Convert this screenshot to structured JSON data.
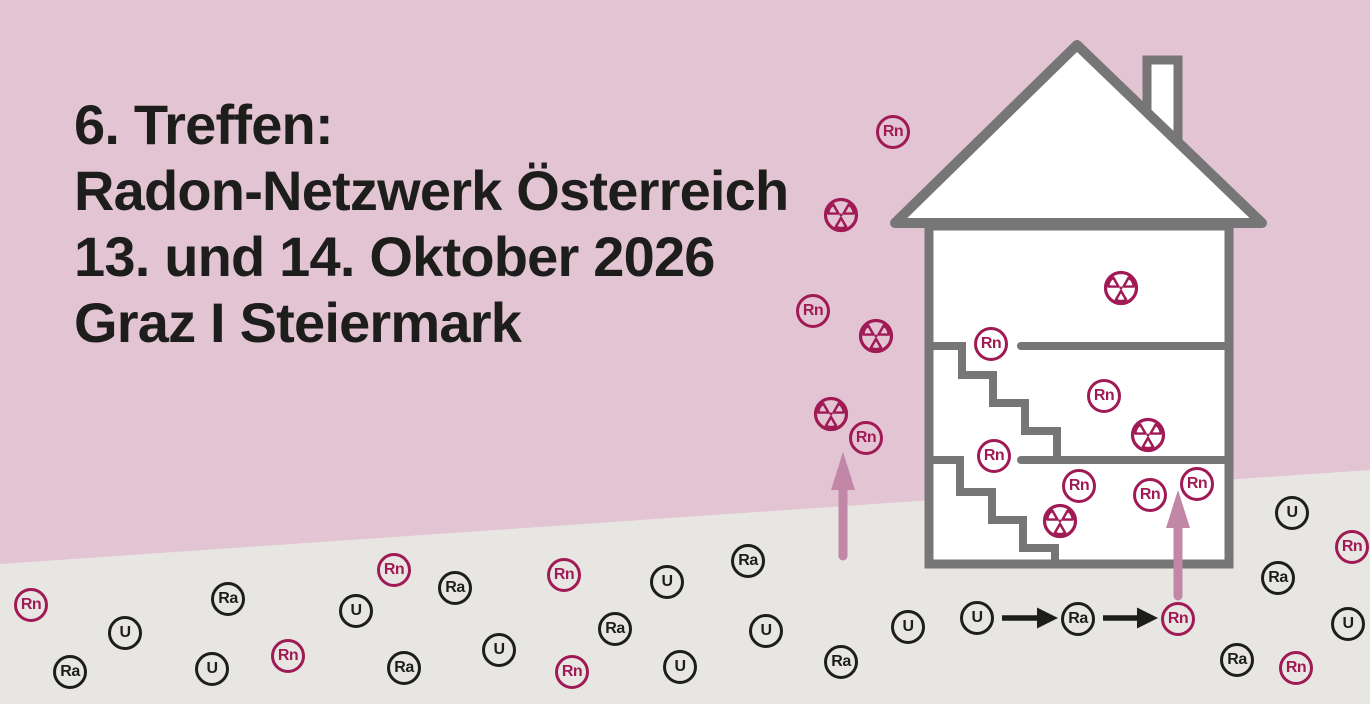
{
  "title": {
    "lines": [
      "6. Treffen:",
      "Radon-Netzwerk Österreich",
      "13. und 14. Oktober 2026",
      "Graz I Steiermark"
    ]
  },
  "colors": {
    "sky_pink": "#e2c4d2",
    "ground_gray": "#e8e6e3",
    "house_gray": "#767676",
    "house_fill": "#ffffff",
    "magenta": "#a01a55",
    "ink": "#1d1d1b",
    "arrow_pink": "#c286a7"
  },
  "symbols": [
    {
      "type": "element",
      "label": "Rn",
      "x": 893,
      "y": 132,
      "color": "magenta"
    },
    {
      "type": "trefoil",
      "x": 841,
      "y": 215,
      "color": "magenta"
    },
    {
      "type": "element",
      "label": "Rn",
      "x": 813,
      "y": 311,
      "color": "magenta"
    },
    {
      "type": "trefoil",
      "x": 876,
      "y": 336,
      "color": "magenta"
    },
    {
      "type": "trefoil",
      "x": 831,
      "y": 414,
      "color": "magenta"
    },
    {
      "type": "element",
      "label": "Rn",
      "x": 866,
      "y": 438,
      "color": "magenta"
    },
    {
      "type": "trefoil",
      "x": 1121,
      "y": 288,
      "color": "magenta"
    },
    {
      "type": "element",
      "label": "Rn",
      "x": 991,
      "y": 344,
      "color": "magenta"
    },
    {
      "type": "element",
      "label": "Rn",
      "x": 1104,
      "y": 396,
      "color": "magenta"
    },
    {
      "type": "trefoil",
      "x": 1148,
      "y": 435,
      "color": "magenta"
    },
    {
      "type": "element",
      "label": "Rn",
      "x": 994,
      "y": 456,
      "color": "magenta"
    },
    {
      "type": "element",
      "label": "Rn",
      "x": 1079,
      "y": 486,
      "color": "magenta"
    },
    {
      "type": "element",
      "label": "Rn",
      "x": 1150,
      "y": 495,
      "color": "magenta"
    },
    {
      "type": "element",
      "label": "Rn",
      "x": 1197,
      "y": 484,
      "color": "magenta"
    },
    {
      "type": "trefoil",
      "x": 1060,
      "y": 521,
      "color": "magenta"
    },
    {
      "type": "element",
      "label": "U",
      "x": 1292,
      "y": 513,
      "color": "black"
    },
    {
      "type": "element",
      "label": "Rn",
      "x": 1352,
      "y": 547,
      "color": "magenta"
    },
    {
      "type": "element",
      "label": "Ra",
      "x": 1278,
      "y": 578,
      "color": "black"
    },
    {
      "type": "element",
      "label": "U",
      "x": 1348,
      "y": 624,
      "color": "black"
    },
    {
      "type": "element",
      "label": "Ra",
      "x": 1237,
      "y": 660,
      "color": "black"
    },
    {
      "type": "element",
      "label": "Rn",
      "x": 1296,
      "y": 668,
      "color": "magenta"
    },
    {
      "type": "element",
      "label": "Rn",
      "x": 31,
      "y": 605,
      "color": "magenta"
    },
    {
      "type": "element",
      "label": "U",
      "x": 125,
      "y": 633,
      "color": "black"
    },
    {
      "type": "element",
      "label": "Ra",
      "x": 70,
      "y": 672,
      "color": "black"
    },
    {
      "type": "element",
      "label": "Ra",
      "x": 228,
      "y": 599,
      "color": "black"
    },
    {
      "type": "element",
      "label": "U",
      "x": 212,
      "y": 669,
      "color": "black"
    },
    {
      "type": "element",
      "label": "Rn",
      "x": 288,
      "y": 656,
      "color": "magenta"
    },
    {
      "type": "element",
      "label": "U",
      "x": 356,
      "y": 611,
      "color": "black"
    },
    {
      "type": "element",
      "label": "Rn",
      "x": 394,
      "y": 570,
      "color": "magenta"
    },
    {
      "type": "element",
      "label": "Ra",
      "x": 455,
      "y": 588,
      "color": "black"
    },
    {
      "type": "element",
      "label": "Ra",
      "x": 404,
      "y": 668,
      "color": "black"
    },
    {
      "type": "element",
      "label": "U",
      "x": 499,
      "y": 650,
      "color": "black"
    },
    {
      "type": "element",
      "label": "Rn",
      "x": 564,
      "y": 575,
      "color": "magenta"
    },
    {
      "type": "element",
      "label": "Ra",
      "x": 615,
      "y": 629,
      "color": "black"
    },
    {
      "type": "element",
      "label": "Rn",
      "x": 572,
      "y": 672,
      "color": "magenta"
    },
    {
      "type": "element",
      "label": "U",
      "x": 667,
      "y": 582,
      "color": "black"
    },
    {
      "type": "element",
      "label": "U",
      "x": 680,
      "y": 667,
      "color": "black"
    },
    {
      "type": "element",
      "label": "Ra",
      "x": 748,
      "y": 561,
      "color": "black"
    },
    {
      "type": "element",
      "label": "U",
      "x": 766,
      "y": 631,
      "color": "black"
    },
    {
      "type": "element",
      "label": "Ra",
      "x": 841,
      "y": 662,
      "color": "black"
    },
    {
      "type": "element",
      "label": "U",
      "x": 908,
      "y": 627,
      "color": "black"
    },
    {
      "type": "element",
      "label": "U",
      "x": 977,
      "y": 618,
      "color": "black"
    },
    {
      "type": "element",
      "label": "Ra",
      "x": 1078,
      "y": 619,
      "color": "black"
    },
    {
      "type": "element",
      "label": "Rn",
      "x": 1178,
      "y": 619,
      "color": "magenta"
    }
  ],
  "arrows": {
    "up": [
      {
        "x": 843,
        "from_y": 556,
        "to_y": 452
      },
      {
        "x": 1178,
        "from_y": 596,
        "to_y": 490
      }
    ],
    "chain": [
      {
        "y": 618,
        "from_x": 1002,
        "to_x": 1058
      },
      {
        "y": 618,
        "from_x": 1103,
        "to_x": 1158
      }
    ]
  }
}
